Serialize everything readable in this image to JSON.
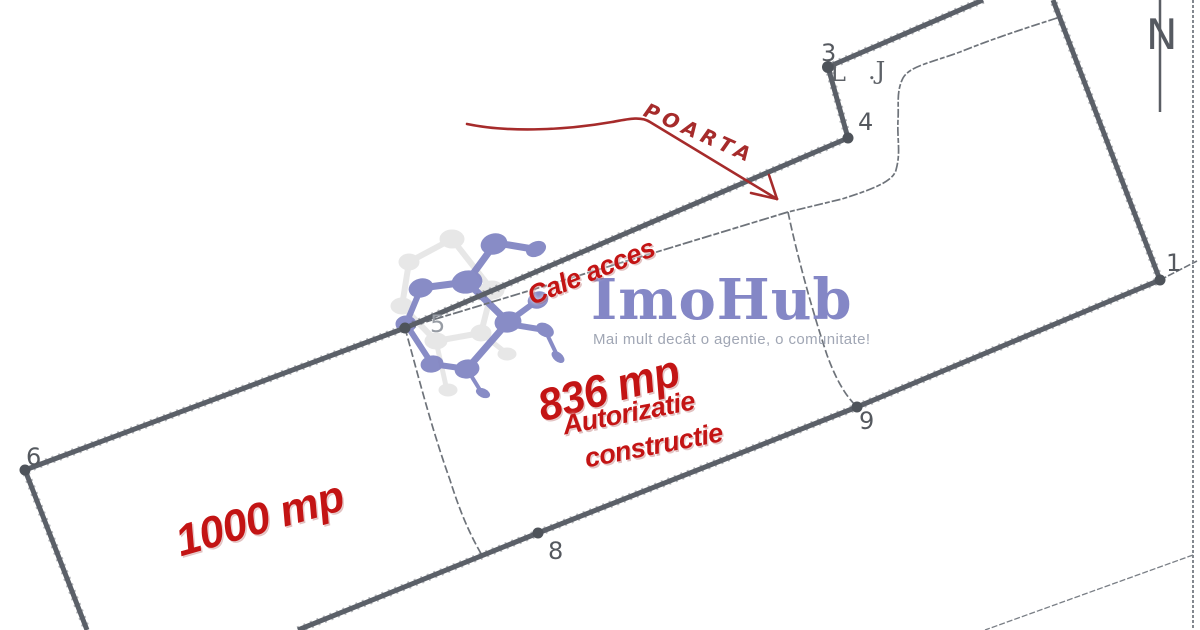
{
  "compass": {
    "label": "N"
  },
  "watermark": {
    "brand": "ImoHub",
    "tagline": "Mai mult decât o agentie, o comunitate!"
  },
  "annotations": {
    "gate_label": "POARTA",
    "access_label": "Cale acces",
    "parcel_main_area": "836 mp",
    "permit_line1": "Autorizatie",
    "permit_line2": "constructie",
    "parcel_left_area": "1000 mp"
  },
  "point_labels": {
    "p1": "1",
    "p3": "3",
    "p4": "4",
    "p5": "5",
    "p6": "6",
    "p8": "8",
    "p9": "9"
  },
  "remnant_marks": {
    "left_mark": "L",
    "right_mark": ".J"
  },
  "colors": {
    "stamp_red": "#c31414",
    "hand_red": "#a62b2b",
    "boundary_gray": "#5b6068",
    "thin_gray": "#6e737a",
    "logo_blue": "#8487c6",
    "tagline_gray": "#a0a6b4",
    "label_gray": "#55595f"
  }
}
